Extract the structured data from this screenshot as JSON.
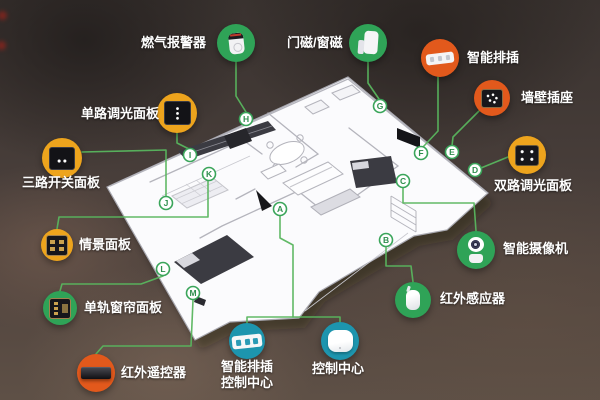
{
  "colors": {
    "green": "#2fa357",
    "deep_orange": "#e2591c",
    "amber": "#eda41d",
    "teal": "#1d95ae",
    "connector_green": "#58b55e",
    "badge_ring_green": "#3aa55a",
    "plan_white": "#fbfbfd",
    "background": "#483e3a"
  },
  "devices": [
    {
      "id": "gas-alarm",
      "label": "燃气报警器",
      "letter": "H",
      "circle_color": "#2fa357"
    },
    {
      "id": "door-window-magnet",
      "label": "门磁/窗磁",
      "letter": "G",
      "circle_color": "#2fa357"
    },
    {
      "id": "smart-power-strip",
      "label": "智能排插",
      "letter": "F",
      "circle_color": "#e2591c"
    },
    {
      "id": "wall-socket",
      "label": "墙壁插座",
      "letter": "E",
      "circle_color": "#e2591c"
    },
    {
      "id": "dual-dimmer-panel",
      "label": "双路调光面板",
      "letter": "D",
      "circle_color": "#eda41d"
    },
    {
      "id": "smart-camera",
      "label": "智能摄像机",
      "letter": "C",
      "circle_color": "#2fa357"
    },
    {
      "id": "ir-sensor",
      "label": "红外感应器",
      "letter": "B",
      "circle_color": "#2fa357"
    },
    {
      "id": "control-center",
      "label": "控制中心",
      "letter": "A",
      "circle_color": "#1d95ae"
    },
    {
      "id": "smart-strip-control-center",
      "label": "智能排插控制中心",
      "label_lines": [
        "智能排插",
        "控制中心"
      ],
      "letter": "A",
      "circle_color": "#1d95ae"
    },
    {
      "id": "ir-remote",
      "label": "红外遥控器",
      "letter": "M",
      "circle_color": "#e2591c"
    },
    {
      "id": "curtain-panel",
      "label": "单轨窗帘面板",
      "letter": "L",
      "circle_color": "#2fa357"
    },
    {
      "id": "scene-panel",
      "label": "情景面板",
      "letter": "K",
      "circle_color": "#eda41d"
    },
    {
      "id": "three-gang-switch-panel",
      "label": "三路开关面板",
      "letter": "J",
      "circle_color": "#eda41d"
    },
    {
      "id": "single-dimmer-panel",
      "label": "单路调光面板",
      "letter": "I",
      "circle_color": "#eda41d"
    }
  ],
  "badges": [
    {
      "letter": "A"
    },
    {
      "letter": "B"
    },
    {
      "letter": "C"
    },
    {
      "letter": "D"
    },
    {
      "letter": "E"
    },
    {
      "letter": "F"
    },
    {
      "letter": "G"
    },
    {
      "letter": "H"
    },
    {
      "letter": "I"
    },
    {
      "letter": "J"
    },
    {
      "letter": "K"
    },
    {
      "letter": "L"
    },
    {
      "letter": "M"
    }
  ]
}
